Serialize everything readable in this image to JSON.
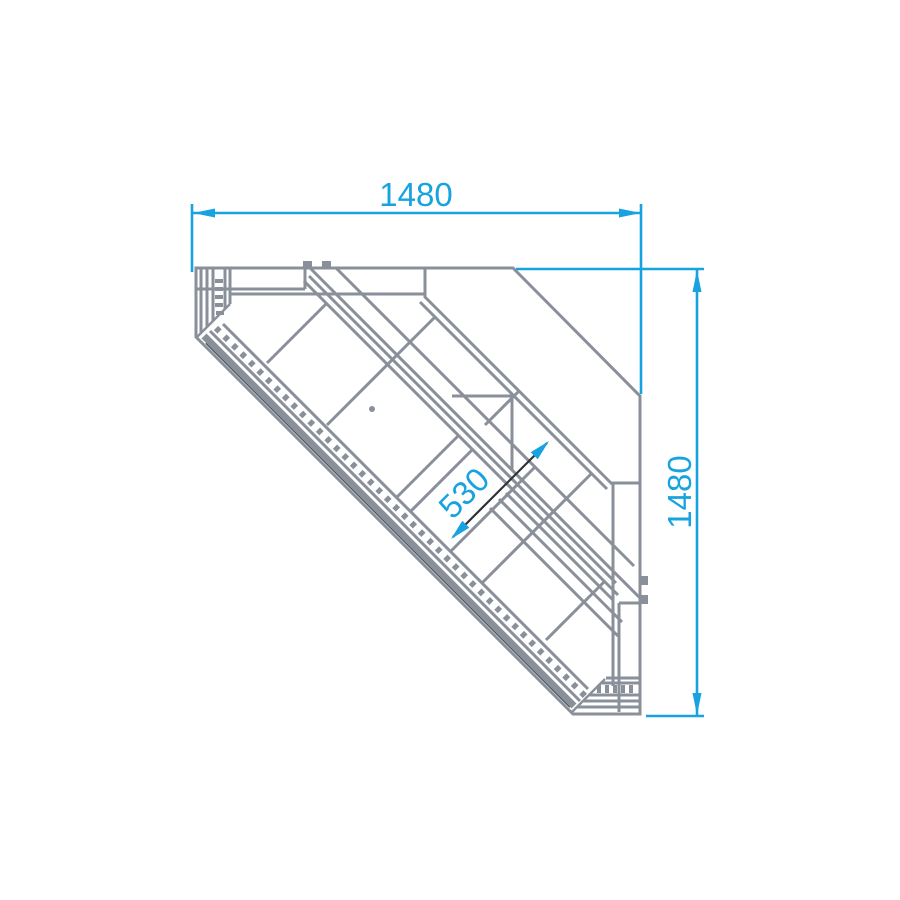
{
  "drawing": {
    "type": "technical-top-view",
    "subject": "corner-display-counter-90deg",
    "dimensions": {
      "top_width": "1480",
      "right_depth": "1480",
      "well_depth": "530"
    },
    "colors": {
      "dimension": "#17A3DF",
      "lines": "#8A9099",
      "dark": "#2F3338",
      "background": "#FFFFFF"
    }
  }
}
